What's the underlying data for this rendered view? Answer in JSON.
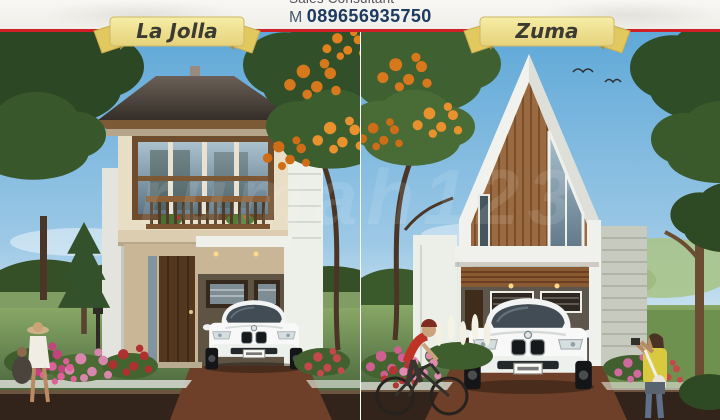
{
  "header": {
    "sales_label": "Sales Consultant",
    "phone_prefix": "M",
    "phone_number": "089656935750"
  },
  "panels": {
    "left": {
      "ribbon_label": "La Jolla"
    },
    "right": {
      "ribbon_label": "Zuma"
    }
  },
  "watermark": {
    "text": "rumah123"
  },
  "colors": {
    "accent_red": "#cf2027",
    "ribbon_yellow": "#f2e694",
    "ribbon_fold": "#e2c95f",
    "phone_navy": "#1d3a60",
    "sky_blue": "#5fa8d8",
    "roof_dark": "#4a4038",
    "wood_brown": "#9a6b42",
    "wall_cream": "#e8dec6",
    "lawn_green": "#5d8544",
    "driveway_brown": "#6f4029",
    "pavement_brown": "#32241a"
  }
}
